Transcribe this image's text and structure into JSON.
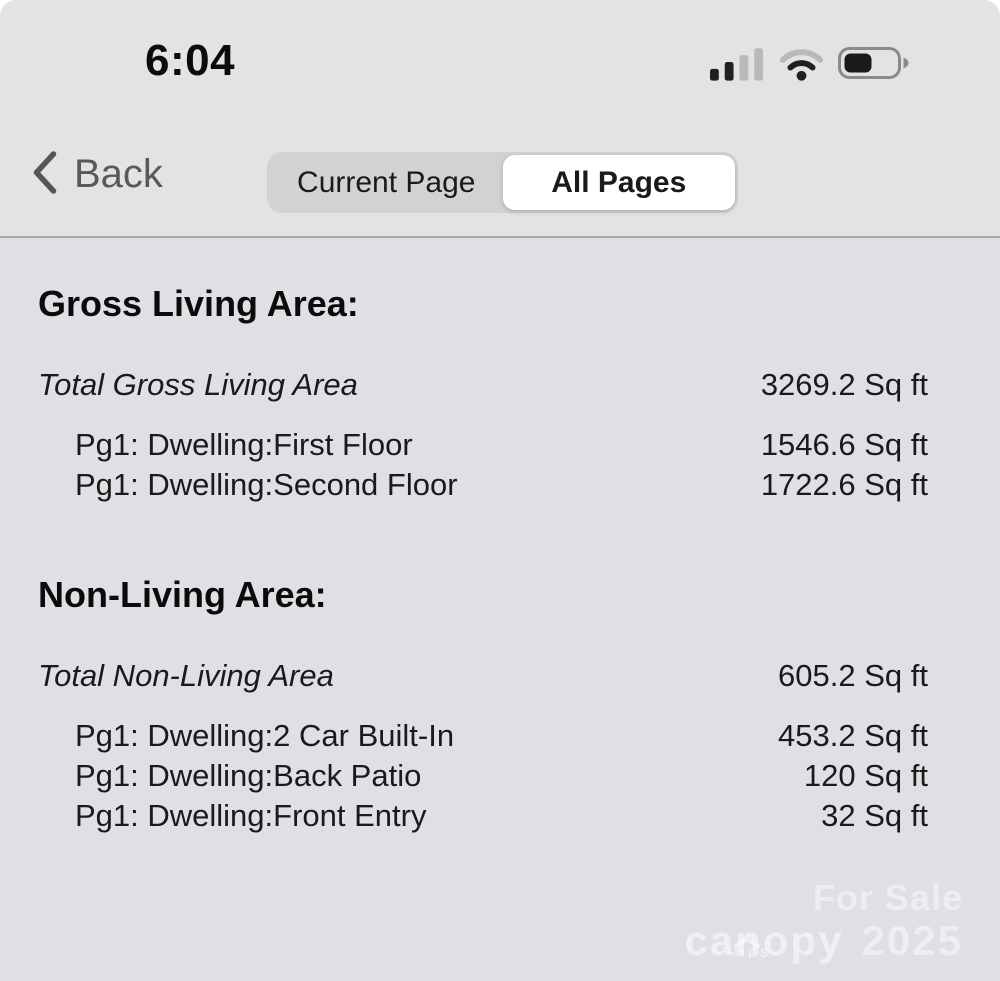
{
  "status_bar": {
    "time": "6:04",
    "cellular": {
      "bars_filled": 2,
      "bars_total": 4
    },
    "wifi": {
      "strength": "2-of-3-arcs"
    },
    "battery": {
      "fill_percent": 45
    }
  },
  "nav": {
    "back_label": "Back",
    "segments": [
      {
        "label": "Current Page",
        "selected": false
      },
      {
        "label": "All Pages",
        "selected": true
      }
    ]
  },
  "report": {
    "sections": [
      {
        "heading": "Gross Living Area:",
        "total": {
          "label": "Total Gross Living Area",
          "value": "3269.2 Sq ft"
        },
        "items": [
          {
            "label": "Pg1: Dwelling:First Floor",
            "value": "1546.6 Sq ft"
          },
          {
            "label": "Pg1: Dwelling:Second Floor",
            "value": "1722.6 Sq ft"
          }
        ]
      },
      {
        "heading": "Non-Living Area:",
        "total": {
          "label": "Total Non-Living Area",
          "value": "605.2 Sq ft"
        },
        "items": [
          {
            "label": "Pg1: Dwelling:2 Car Built-In",
            "value": "453.2 Sq ft"
          },
          {
            "label": "Pg1: Dwelling:Back Patio",
            "value": "120 Sq ft"
          },
          {
            "label": "Pg1: Dwelling:Front Entry",
            "value": "32 Sq ft"
          }
        ]
      }
    ]
  },
  "watermark": {
    "sale_text": "For Sale",
    "brand": "canopy",
    "brand_sub": "MLS",
    "year": "2025"
  },
  "colors": {
    "header_bg": "#e3e3e2",
    "content_bg": "#dfe0e4",
    "segmented_bg": "#d2d2d4",
    "segment_selected_bg": "#ffffff",
    "divider": "#a9a9ab",
    "heading_text": "#0b0b0c",
    "row_text": "#1a1a1b",
    "back_text": "#59595b",
    "watermark_text": "rgba(255,255,255,0.45)"
  }
}
